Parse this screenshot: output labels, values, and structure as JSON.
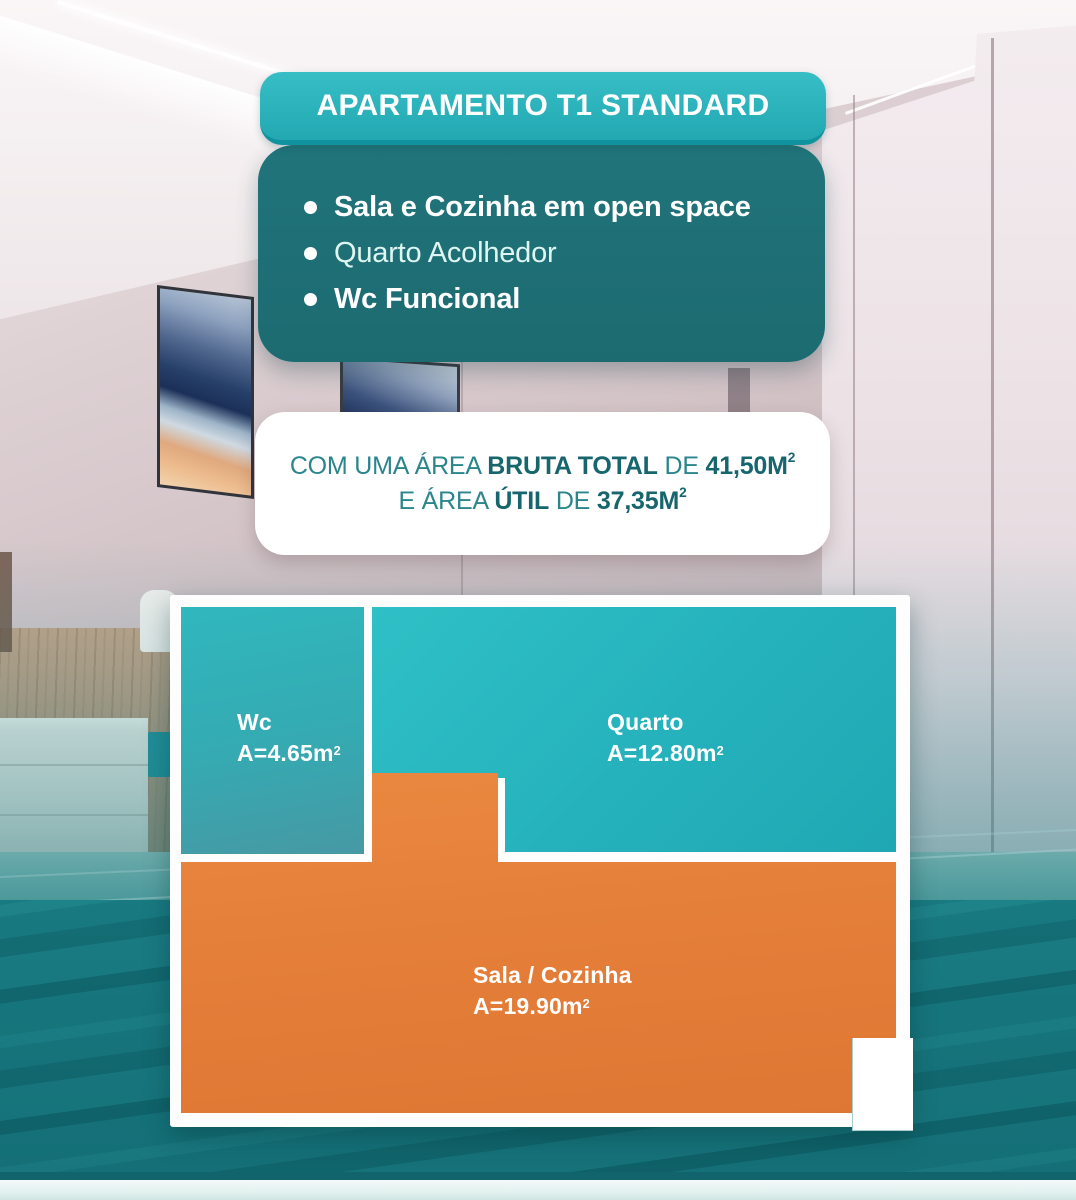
{
  "poster": {
    "title": "APARTAMENTO T1 STANDARD",
    "features": [
      {
        "label": "Sala e Cozinha em open space"
      },
      {
        "label": "Quarto Acolhedor"
      },
      {
        "label": "Wc Funcional"
      }
    ],
    "area_summary": {
      "line1": {
        "pre": "COM UMA ÁREA ",
        "bold": "BRUTA TOTAL",
        "mid": " DE ",
        "value": "41,50M",
        "value_sup": "2"
      },
      "line2": {
        "pre": "E ÁREA ",
        "bold": "ÚTIL",
        "mid": " DE ",
        "value": "37,35M",
        "value_sup": "2"
      }
    },
    "floor_plan": {
      "wc": {
        "name": "Wc",
        "area": "A=4.65m",
        "area_sup": "2"
      },
      "quarto": {
        "name": "Quarto",
        "area": "A=12.80m",
        "area_sup": "2"
      },
      "sala": {
        "name": "Sala / Cozinha",
        "area": "A=19.90m",
        "area_sup": "2"
      }
    },
    "colors": {
      "badge_teal": "#2ab1ba",
      "card_dark_teal": "#1d6e74",
      "room_teal": "#29b2bc",
      "room_orange": "#e5813c",
      "area_text_teal": "#27808a"
    }
  }
}
